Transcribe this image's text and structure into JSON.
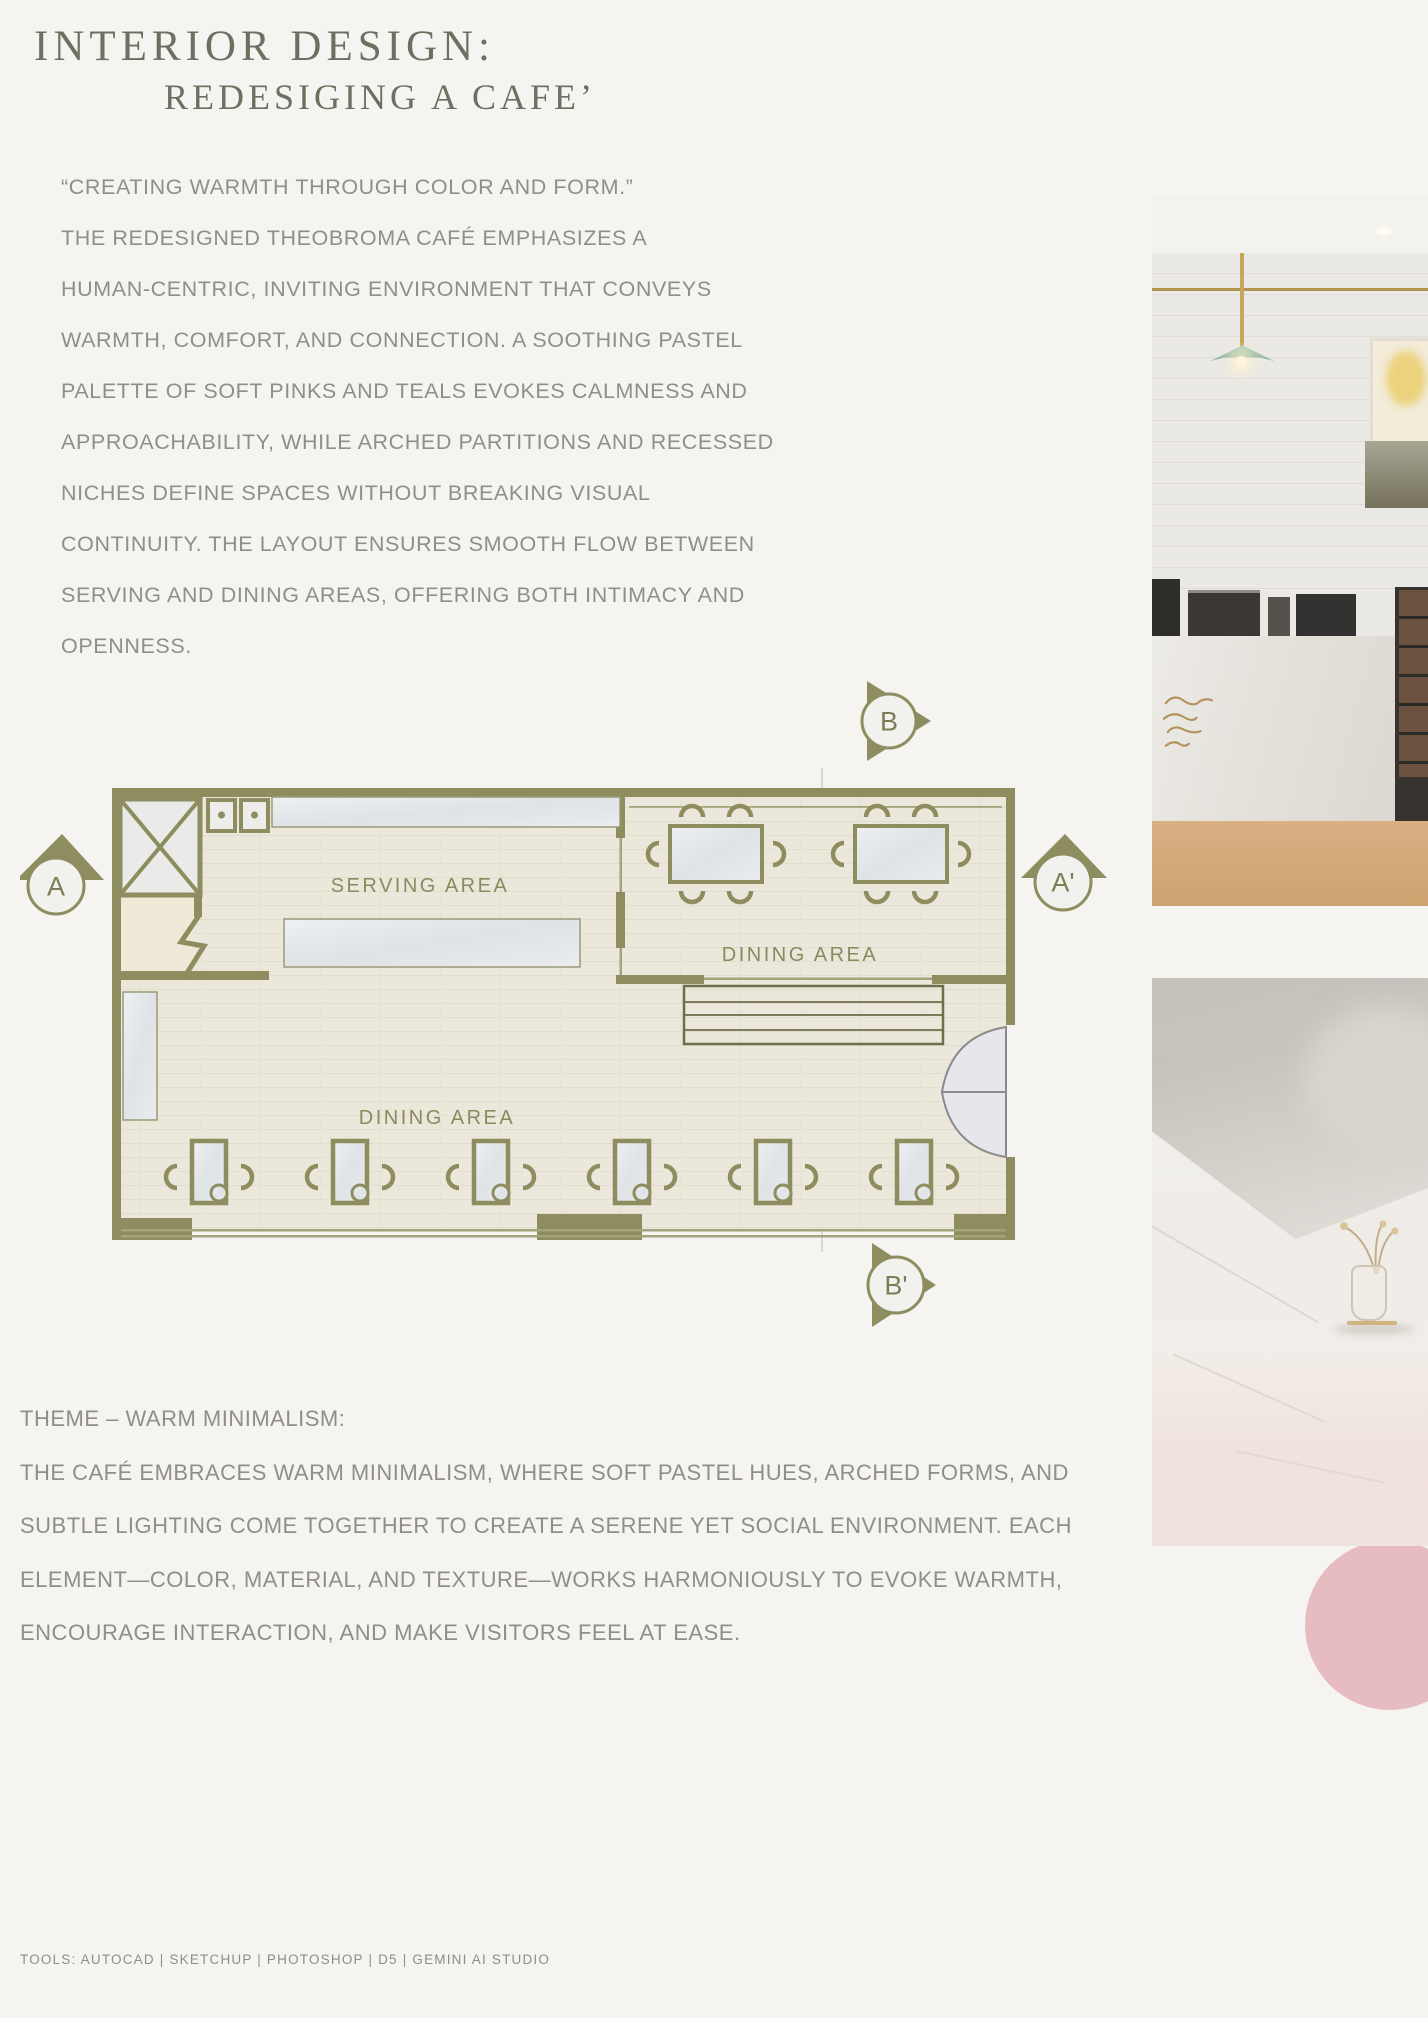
{
  "header": {
    "title_line1": "INTERIOR DESIGN:",
    "title_line2": "REDESIGING A CAFE’"
  },
  "intro": {
    "lines": [
      "“CREATING WARMTH THROUGH COLOR AND FORM.”",
      "THE REDESIGNED THEOBROMA CAFÉ EMPHASIZES A",
      "HUMAN-CENTRIC, INVITING ENVIRONMENT THAT CONVEYS",
      "WARMTH, COMFORT, AND CONNECTION. A SOOTHING PASTEL",
      "PALETTE OF SOFT PINKS AND TEALS EVOKES CALMNESS AND",
      "APPROACHABILITY, WHILE ARCHED PARTITIONS AND RECESSED",
      "NICHES DEFINE SPACES WITHOUT BREAKING VISUAL",
      "CONTINUITY. THE LAYOUT ENSURES SMOOTH FLOW BETWEEN",
      "SERVING AND DINING AREAS, OFFERING BOTH INTIMACY AND",
      "OPENNESS."
    ]
  },
  "floor_plan": {
    "serving_area_label": "SERVING AREA",
    "dining_area_upper_label": "DINING AREA",
    "dining_area_lower_label": "DINING AREA",
    "marker_a": "A",
    "marker_a_prime": "A'",
    "marker_b": "B",
    "marker_b_prime": "B'"
  },
  "theme": {
    "heading": "THEME – WARM MINIMALISM:",
    "lines": [
      "THE CAFÉ EMBRACES WARM MINIMALISM, WHERE SOFT PASTEL HUES, ARCHED FORMS, AND",
      "SUBTLE LIGHTING COME TOGETHER TO CREATE A SERENE YET SOCIAL ENVIRONMENT. EACH",
      "ELEMENT—COLOR, MATERIAL, AND TEXTURE—WORKS HARMONIOUSLY TO EVOKE WARMTH,",
      "ENCOURAGE INTERACTION, AND MAKE VISITORS FEEL AT EASE."
    ]
  },
  "footer": {
    "tools": "TOOLS: AUTOCAD | SKETCHUP | PHOTOSHOP | D5 | GEMINI AI STUDIO"
  },
  "colors": {
    "background": "#f5f4f1",
    "olive_wall": "#8d8d5f",
    "title_text": "#6d7060",
    "body_text": "#908e88",
    "plan_floor": "#ece7db",
    "marble": "#e6e9ea",
    "pink_accent": "#e7bcc1",
    "lamp_green": "#a9c7b2",
    "brass": "#bd9d55",
    "wood": "#d2a978"
  }
}
